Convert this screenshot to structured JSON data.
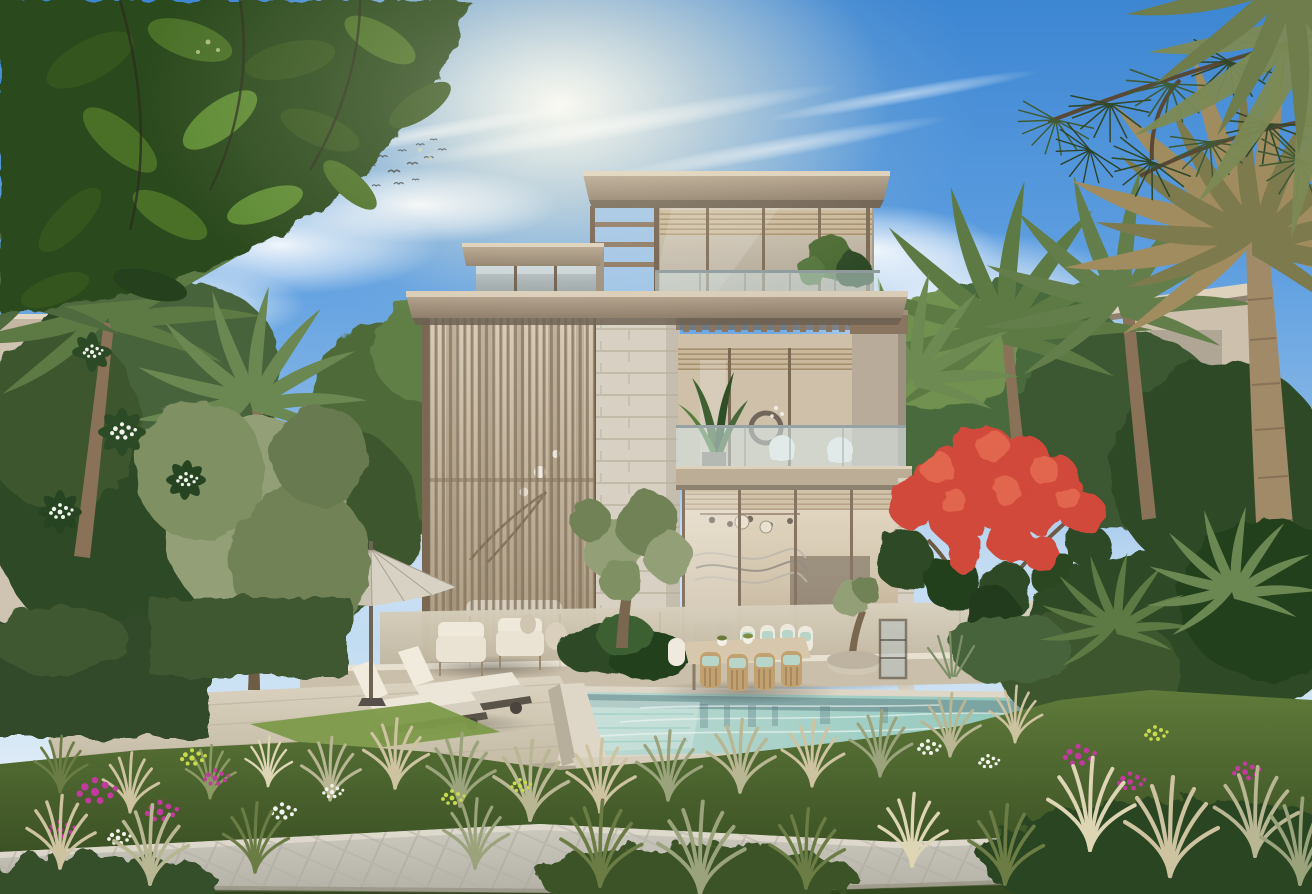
{
  "image": {
    "kind": "3d architectural rendering",
    "subject": "Modern three-storey villa with landscaped garden and swimming pool",
    "setting": "daytime, clear blue sky with wispy clouds and a flock of birds"
  },
  "scene": {
    "sky": {
      "description": "blue sky, soft sun glow upper centre-left, wispy clouds, cumulus right of tower",
      "birds": "small flock upper left of the villa"
    },
    "buildings": {
      "main_villa": {
        "storeys": 3,
        "features": [
          "flat cantilevered roof slabs in champagne bronze",
          "double-height vertical louvre screen over glazed wall",
          "travertine stone piers",
          "bronze-framed floor-to-ceiling glazing",
          "second-floor balcony with glass balustrade and slatted pergola",
          "roof-level terrace with glass balustrade and planting"
        ]
      },
      "neighbour_left": "beige villa facade partially hidden behind palms and plumeria",
      "neighbour_right": "beige villa with thin roof slab partially hidden behind palms"
    },
    "pool": {
      "shape": "rectangular with raised stone rim at near-left corner",
      "water": "pale turquoise with sky reflections",
      "surround": "travertine coping and deck"
    },
    "terrace_furniture": [
      "two sun loungers with white cushions",
      "beige garden parasol",
      "cream lounge armchairs with ceramic jar side tables",
      "outdoor dining table with timber chairs and seafoam cushions",
      "stone planter bowl with olive sapling",
      "glass lantern cabinet"
    ],
    "balcony_furniture": [
      "two white wire lounge chairs",
      "potted banana plant",
      "round dark wall art"
    ],
    "interior_hints": [
      "sheer curtains",
      "wavy metal wall art",
      "pendant spheres",
      "dark grey lounge chairs"
    ],
    "garden": {
      "plants": [
        "date palms",
        "olive trees",
        "red flame tree (royal poinciana)",
        "white plumeria",
        "clipped hedges",
        "feathery ornamental grasses",
        "magenta, white and yellow-green ground flowers",
        "overhanging ficus leaves top-left",
        "pine branches top-right"
      ],
      "hardscape": [
        "stepped travertine deck",
        "paved footpath across the foreground"
      ]
    }
  },
  "palette": {
    "sky_top": "#3d86d2",
    "sky_horizon": "#e6f1f8",
    "sun_glow": "#fff6dc",
    "cloud": "#ffffff",
    "bird": "#3a4148",
    "roof": "#9a8a76",
    "roof_edge": "#dcd0ba",
    "bronze": "#8a7560",
    "bronze_dark": "#6e5c4a",
    "stone": "#d8d1c3",
    "stone_joint": "#c3bba9",
    "curtain": "#c9baa2",
    "glass_cool": "#a8b3b6",
    "balustrade": "#cfe0e4",
    "water": "#a9d2c9",
    "water_deep": "#6d8f92",
    "water_light": "#dcebe6",
    "coping": "#ded6c6",
    "deck": "#d5ccb9",
    "deck_shadow": "#b0a691",
    "path": "#c5c2b8",
    "lawn": "#7d9a4a",
    "leaf_dark": "#2f4a26",
    "leaf_mid": "#4c6b33",
    "leaf_light": "#7c9a49",
    "olive_leaf": "#93a077",
    "palm_green": "#5d7a45",
    "palm_dry": "#a08c5e",
    "trunk": "#8a7258",
    "hedge": "#33492b",
    "grass_straw": "#cdc3a0",
    "flower_magenta": "#c23a9e",
    "flower_white": "#f2f3ec",
    "flower_yellow": "#c9d94e",
    "flame_red": "#d1483a",
    "upholstery_cream": "#eae3d4",
    "chair_timber": "#c2a171",
    "cushion_aqua": "#b7d6c9",
    "parasol": "#d8d2c4"
  }
}
